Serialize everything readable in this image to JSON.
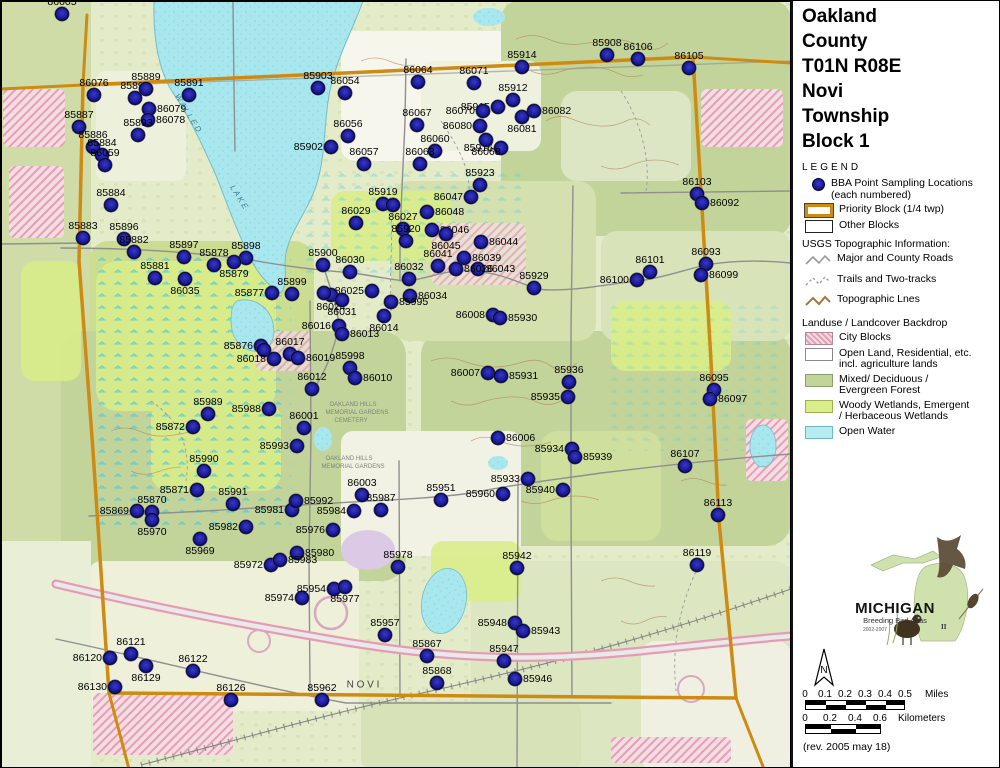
{
  "title": {
    "lines": [
      "Oakland",
      "County",
      "T01N R08E",
      "Novi",
      "Township",
      "Block 1"
    ]
  },
  "legend": {
    "heading": "LEGEND",
    "points_item": {
      "label": "BBA Point Sampling Locations",
      "sublabel": "(each numbered)"
    },
    "priority_block": "Priority Block (1/4 twp)",
    "other_blocks": "Other Blocks",
    "usgs_heading": "USGS Topographic Information:",
    "usgs_items": [
      {
        "label": "Major and County Roads",
        "type": "road"
      },
      {
        "label": "Trails and Two-tracks",
        "type": "trail"
      },
      {
        "label": "Topographic Lnes",
        "type": "topo"
      }
    ],
    "landuse_heading": "Landuse / Landcover Backdrop",
    "landuse_items": [
      {
        "line1": "City Blocks",
        "line2": ""
      },
      {
        "line1": "Open Land, Residential, etc.",
        "line2": "incl. agriculture lands"
      },
      {
        "line1": "Mixed/ Deciduous /",
        "line2": "Evergreen Forest"
      },
      {
        "line1": "Woody Wetlands, Emergent",
        "line2": "/ Herbaceous Wetlands"
      },
      {
        "line1": "Open Water",
        "line2": ""
      }
    ]
  },
  "logo": {
    "name": "MICHIGAN",
    "subtitle": "Breeding Bird Atlas",
    "years": "2002-2007",
    "numeral": "II"
  },
  "north_label": "N",
  "scales": {
    "miles": {
      "ticks": [
        "0",
        "0.1",
        "0.2",
        "0.3",
        "0.4",
        "0.5"
      ],
      "unit": "Miles"
    },
    "km": {
      "ticks": [
        "0",
        "0.2",
        "0.4",
        "0.6"
      ],
      "unit": "Kilometers"
    }
  },
  "revision": "(rev. 2005 may 18)",
  "map": {
    "colors": {
      "point_fill": "#1b1b9a",
      "point_stroke": "#02023a",
      "block_border": "#cf8a12",
      "water": "#a9e7ee",
      "forest": "#c3d49b",
      "wetland": "#d9ed8a",
      "city": "#f2ccd8",
      "contour": "#b08050",
      "road": "#8f8f8f"
    },
    "place_labels": [
      {
        "text": "W A L L E D",
        "x": 187,
        "y": 112,
        "rot": 58,
        "size": 8,
        "color": "#3f7f95",
        "italic": true
      },
      {
        "text": "L A K E",
        "x": 238,
        "y": 196,
        "rot": 58,
        "size": 8,
        "color": "#3f7f95",
        "italic": true
      },
      {
        "text": "N O V I",
        "x": 362,
        "y": 684,
        "rot": 0,
        "size": 10,
        "color": "#444",
        "italic": false
      },
      {
        "text": "OAKLAND HILLS",
        "x": 352,
        "y": 404,
        "rot": 0,
        "size": 6,
        "color": "#808080",
        "italic": false
      },
      {
        "text": "MEMORIAL GARDENS",
        "x": 356,
        "y": 412,
        "rot": 0,
        "size": 6,
        "color": "#808080",
        "italic": false
      },
      {
        "text": "CEMETERY",
        "x": 350,
        "y": 420,
        "rot": 0,
        "size": 6,
        "color": "#808080",
        "italic": false
      },
      {
        "text": "OAKLAND HILLS",
        "x": 348,
        "y": 458,
        "rot": 0,
        "size": 6,
        "color": "#808080",
        "italic": false
      },
      {
        "text": "MEMORIAL GARDENS",
        "x": 352,
        "y": 466,
        "rot": 0,
        "size": 6,
        "color": "#808080",
        "italic": false
      }
    ],
    "points": [
      [
        "86005",
        61,
        13
      ],
      [
        "86076",
        93,
        94
      ],
      [
        "85890",
        134,
        97
      ],
      [
        "85889",
        145,
        88
      ],
      [
        "85891",
        188,
        94
      ],
      [
        "86079",
        148,
        108,
        "r"
      ],
      [
        "86078",
        147,
        119,
        "r"
      ],
      [
        "85893",
        137,
        134
      ],
      [
        "85887",
        78,
        126
      ],
      [
        "85886",
        92,
        146
      ],
      [
        "85884",
        101,
        154
      ],
      [
        "86059",
        104,
        164
      ],
      [
        "85884",
        110,
        204
      ],
      [
        "85883",
        82,
        237
      ],
      [
        "85896",
        123,
        238
      ],
      [
        "85882",
        133,
        251
      ],
      [
        "85897",
        183,
        256
      ],
      [
        "85878",
        213,
        264
      ],
      [
        "85898",
        245,
        257
      ],
      [
        "85879",
        233,
        261,
        "b"
      ],
      [
        "85881",
        154,
        277
      ],
      [
        "86035",
        184,
        278,
        "b"
      ],
      [
        "85903",
        317,
        87
      ],
      [
        "86054",
        344,
        92
      ],
      [
        "86064",
        417,
        81
      ],
      [
        "86071",
        473,
        82
      ],
      [
        "85914",
        521,
        66
      ],
      [
        "85908",
        606,
        54
      ],
      [
        "86106",
        637,
        58
      ],
      [
        "86105",
        688,
        67
      ],
      [
        "85912",
        512,
        99
      ],
      [
        "85915",
        497,
        106,
        "l"
      ],
      [
        "86082",
        533,
        110,
        "r"
      ],
      [
        "86081",
        521,
        116,
        "b"
      ],
      [
        "85916",
        500,
        147,
        "l"
      ],
      [
        "86070",
        482,
        110,
        "l"
      ],
      [
        "86080",
        479,
        125,
        "l"
      ],
      [
        "86067",
        416,
        124
      ],
      [
        "86056",
        347,
        135
      ],
      [
        "85902",
        330,
        146,
        "l"
      ],
      [
        "86060",
        434,
        150
      ],
      [
        "86068",
        485,
        139,
        "b"
      ],
      [
        "86057",
        363,
        163
      ],
      [
        "86063",
        419,
        163
      ],
      [
        "85923",
        479,
        184
      ],
      [
        "86047",
        470,
        196,
        "l"
      ],
      [
        "85919",
        382,
        203
      ],
      [
        "",
        392,
        204
      ],
      [
        "86029",
        355,
        222
      ],
      [
        "86027",
        402,
        228
      ],
      [
        "86048",
        426,
        211,
        "r"
      ],
      [
        "86046",
        431,
        229,
        "r"
      ],
      [
        "86045",
        445,
        233,
        "b"
      ],
      [
        "86044",
        480,
        241,
        "r"
      ],
      [
        "85920",
        405,
        240
      ],
      [
        "86041",
        437,
        265
      ],
      [
        "86039",
        463,
        257,
        "r"
      ],
      [
        "86043",
        477,
        268,
        "r"
      ],
      [
        "85900",
        322,
        264
      ],
      [
        "86030",
        349,
        271
      ],
      [
        "86032",
        408,
        278
      ],
      [
        "86026",
        455,
        268,
        "r"
      ],
      [
        "86025",
        371,
        290,
        "l"
      ],
      [
        "86034",
        409,
        295,
        "r"
      ],
      [
        "85995",
        390,
        301,
        "r"
      ],
      [
        "86024",
        330,
        294,
        "b"
      ],
      [
        "",
        323,
        292
      ],
      [
        "86031",
        341,
        299,
        "b"
      ],
      [
        "86008",
        492,
        314,
        "l"
      ],
      [
        "85930",
        499,
        317,
        "r"
      ],
      [
        "85929",
        533,
        287
      ],
      [
        "86100",
        636,
        279,
        "l"
      ],
      [
        "86101",
        649,
        271
      ],
      [
        "86093",
        705,
        263
      ],
      [
        "86099",
        700,
        274,
        "r"
      ],
      [
        "86103",
        696,
        193
      ],
      [
        "86092",
        701,
        202,
        "r"
      ],
      [
        "85877",
        271,
        292,
        "l"
      ],
      [
        "85899",
        291,
        293
      ],
      [
        "86016",
        338,
        325,
        "l"
      ],
      [
        "86013",
        341,
        333,
        "r"
      ],
      [
        "86014",
        383,
        315,
        "b"
      ],
      [
        "85876",
        260,
        345,
        "l"
      ],
      [
        "",
        263,
        349
      ],
      [
        "86017",
        289,
        353
      ],
      [
        "86019",
        297,
        357,
        "r"
      ],
      [
        "86018",
        273,
        358,
        "l"
      ],
      [
        "85998",
        349,
        367
      ],
      [
        "86012",
        311,
        388
      ],
      [
        "86010",
        354,
        377,
        "r"
      ],
      [
        "86007",
        487,
        372,
        "l"
      ],
      [
        "85931",
        500,
        375,
        "r"
      ],
      [
        "85988",
        268,
        408,
        "l"
      ],
      [
        "86001",
        303,
        427
      ],
      [
        "85993",
        296,
        445,
        "l"
      ],
      [
        "86006",
        497,
        437,
        "r"
      ],
      [
        "85989",
        207,
        413
      ],
      [
        "85872",
        192,
        426,
        "l"
      ],
      [
        "85990",
        203,
        470
      ],
      [
        "85871",
        196,
        489,
        "l"
      ],
      [
        "85869",
        136,
        510,
        "l"
      ],
      [
        "85870",
        151,
        511
      ],
      [
        "85970",
        151,
        519,
        "b"
      ],
      [
        "85991",
        232,
        503
      ],
      [
        "85981",
        291,
        509,
        "l"
      ],
      [
        "85992",
        295,
        500,
        "r"
      ],
      [
        "85982",
        245,
        526,
        "l"
      ],
      [
        "85969",
        199,
        538,
        "b"
      ],
      [
        "85980",
        296,
        552,
        "r"
      ],
      [
        "85972",
        270,
        564,
        "l"
      ],
      [
        "85983",
        279,
        559,
        "r"
      ],
      [
        "85974",
        301,
        597,
        "l"
      ],
      [
        "85954",
        333,
        588,
        "l"
      ],
      [
        "85977",
        344,
        586,
        "b"
      ],
      [
        "85976",
        332,
        529,
        "l"
      ],
      [
        "85978",
        397,
        566
      ],
      [
        "85957",
        384,
        634
      ],
      [
        "85936",
        568,
        381
      ],
      [
        "85935",
        567,
        396,
        "l"
      ],
      [
        "85934",
        571,
        448,
        "l"
      ],
      [
        "85939",
        574,
        456,
        "r"
      ],
      [
        "86095",
        713,
        389
      ],
      [
        "86097",
        709,
        398,
        "r"
      ],
      [
        "86107",
        684,
        465
      ],
      [
        "85933",
        527,
        478,
        "l"
      ],
      [
        "85940",
        562,
        489,
        "l"
      ],
      [
        "85960",
        502,
        493,
        "l"
      ],
      [
        "86113",
        717,
        514
      ],
      [
        "86119",
        696,
        564
      ],
      [
        "85951",
        440,
        499
      ],
      [
        "86003",
        361,
        494
      ],
      [
        "85984",
        353,
        510,
        "l"
      ],
      [
        "85987",
        380,
        509
      ],
      [
        "85942",
        516,
        567
      ],
      [
        "85948",
        514,
        622,
        "l"
      ],
      [
        "85943",
        522,
        630,
        "r"
      ],
      [
        "85947",
        503,
        660
      ],
      [
        "85946",
        514,
        678,
        "r"
      ],
      [
        "85867",
        426,
        655
      ],
      [
        "85868",
        436,
        682
      ],
      [
        "86120",
        109,
        657,
        "l"
      ],
      [
        "86121",
        130,
        653
      ],
      [
        "86129",
        145,
        665,
        "b"
      ],
      [
        "86122",
        192,
        670
      ],
      [
        "86130",
        114,
        686,
        "l"
      ],
      [
        "86126",
        230,
        699
      ],
      [
        "85962",
        321,
        699
      ]
    ]
  }
}
